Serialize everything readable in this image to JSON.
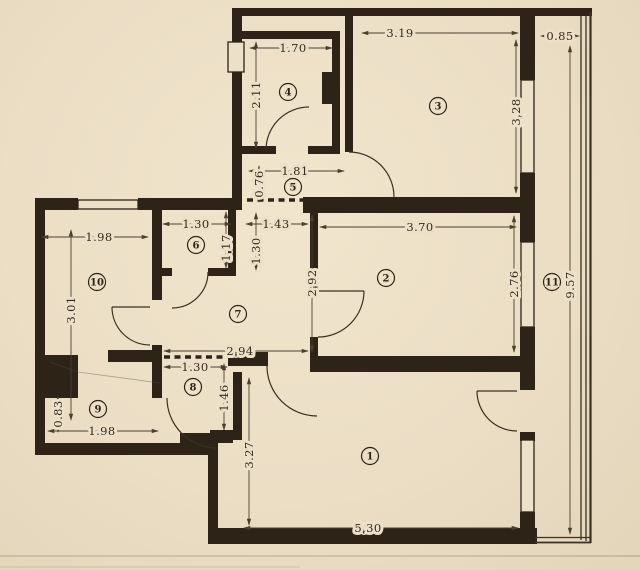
{
  "colors": {
    "paper": "#ece0c8",
    "ink": "#2d2417",
    "dim_line": "#4a4030"
  },
  "floorplan": {
    "rooms": [
      {
        "number": "1",
        "x": 370,
        "y": 456
      },
      {
        "number": "2",
        "x": 386,
        "y": 278
      },
      {
        "number": "3",
        "x": 438,
        "y": 106
      },
      {
        "number": "4",
        "x": 288,
        "y": 92
      },
      {
        "number": "5",
        "x": 293,
        "y": 187
      },
      {
        "number": "6",
        "x": 196,
        "y": 245
      },
      {
        "number": "7",
        "x": 238,
        "y": 314
      },
      {
        "number": "8",
        "x": 193,
        "y": 387
      },
      {
        "number": "9",
        "x": 98,
        "y": 409
      },
      {
        "number": "10",
        "x": 97,
        "y": 282
      },
      {
        "number": "11",
        "x": 552,
        "y": 282
      }
    ],
    "dimensions": [
      {
        "text": "1.70",
        "x": 293,
        "y": 48,
        "rot": false
      },
      {
        "text": "3.19",
        "x": 400,
        "y": 33,
        "rot": false
      },
      {
        "text": "0.85",
        "x": 560,
        "y": 36,
        "rot": false
      },
      {
        "text": "2.11",
        "x": 256,
        "y": 95,
        "rot": true
      },
      {
        "text": "3.28",
        "x": 516,
        "y": 112,
        "rot": true
      },
      {
        "text": "9.57",
        "x": 570,
        "y": 285,
        "rot": true
      },
      {
        "text": "1.81",
        "x": 295,
        "y": 171,
        "rot": false
      },
      {
        "text": "0.76",
        "x": 259,
        "y": 184,
        "rot": true
      },
      {
        "text": "1.30",
        "x": 196,
        "y": 224,
        "rot": false
      },
      {
        "text": "1.43",
        "x": 276,
        "y": 224,
        "rot": false
      },
      {
        "text": "3.70",
        "x": 420,
        "y": 227,
        "rot": false
      },
      {
        "text": "1.17",
        "x": 226,
        "y": 248,
        "rot": true
      },
      {
        "text": "1.30",
        "x": 256,
        "y": 251,
        "rot": true
      },
      {
        "text": "1.98",
        "x": 99,
        "y": 237,
        "rot": false
      },
      {
        "text": "3.01",
        "x": 71,
        "y": 310,
        "rot": true
      },
      {
        "text": "2.92",
        "x": 312,
        "y": 283,
        "rot": true
      },
      {
        "text": "2.76",
        "x": 514,
        "y": 284,
        "rot": true
      },
      {
        "text": "2.94",
        "x": 240,
        "y": 351,
        "rot": false
      },
      {
        "text": "1.30",
        "x": 195,
        "y": 367,
        "rot": false
      },
      {
        "text": "1.46",
        "x": 224,
        "y": 398,
        "rot": true
      },
      {
        "text": "0.83",
        "x": 58,
        "y": 414,
        "rot": true
      },
      {
        "text": "1.98",
        "x": 102,
        "y": 431,
        "rot": false
      },
      {
        "text": "3.27",
        "x": 249,
        "y": 455,
        "rot": true
      },
      {
        "text": "5.30",
        "x": 368,
        "y": 528,
        "rot": false
      }
    ]
  }
}
